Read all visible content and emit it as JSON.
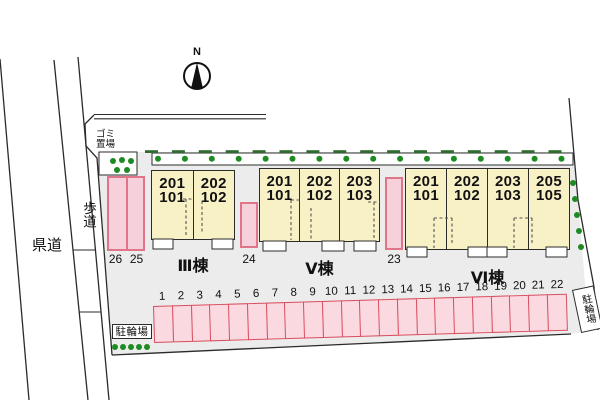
{
  "colors": {
    "site_fill": "#ececec",
    "building_fill": "#f9f1c6",
    "building_line": "#2b2b2b",
    "parking_fill": "#fbd9e1",
    "parking_border": "#d84f5f",
    "side_space_fill": "#f6d0da",
    "side_space_border": "#e0758a",
    "greenery": "#1e8a22",
    "line": "#2b2b2b"
  },
  "compass": {
    "north_label": "N"
  },
  "roads": {
    "prefectural_road": "県道",
    "sidewalk": "歩道"
  },
  "garbage_area": {
    "label_line1": "ゴミ",
    "label_line2": "置場"
  },
  "buildings": [
    {
      "name": "Ⅲ棟",
      "units": [
        {
          "upper": "201",
          "lower": "101"
        },
        {
          "upper": "202",
          "lower": "102"
        }
      ]
    },
    {
      "name": "Ⅴ棟",
      "units": [
        {
          "upper": "201",
          "lower": "101"
        },
        {
          "upper": "202",
          "lower": "102"
        },
        {
          "upper": "203",
          "lower": "103"
        }
      ]
    },
    {
      "name": "Ⅵ棟",
      "units": [
        {
          "upper": "201",
          "lower": "101"
        },
        {
          "upper": "202",
          "lower": "102"
        },
        {
          "upper": "203",
          "lower": "103"
        },
        {
          "upper": "205",
          "lower": "105"
        }
      ]
    }
  ],
  "side_spaces": {
    "pair": [
      "26",
      "25"
    ],
    "middle": "24",
    "right": "23"
  },
  "parking_row": {
    "numbers": [
      "1",
      "2",
      "3",
      "4",
      "5",
      "6",
      "7",
      "8",
      "9",
      "10",
      "11",
      "12",
      "13",
      "14",
      "15",
      "16",
      "17",
      "18",
      "19",
      "20",
      "21",
      "22"
    ]
  },
  "bicycle_parking": {
    "left_label": "駐輪場",
    "right_label": "駐輪場"
  }
}
